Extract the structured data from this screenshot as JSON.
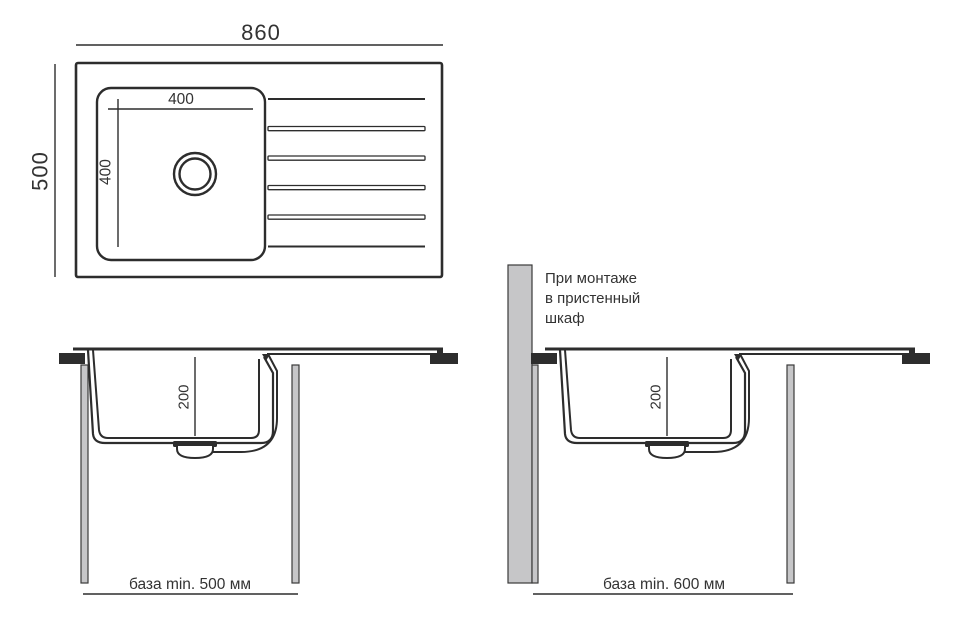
{
  "colors": {
    "line": "#2d2d2d",
    "text": "#333333",
    "panel_fill": "#c6c6c8",
    "panel_stroke": "#3a3a3a",
    "background": "#ffffff"
  },
  "top_view": {
    "overall_width_mm": "860",
    "overall_depth_mm": "500",
    "bowl_width_mm": "400",
    "bowl_length_mm": "400"
  },
  "section_standard": {
    "bowl_depth_mm": "200",
    "base_label": "база min. 500 мм"
  },
  "section_wall_cabinet": {
    "bowl_depth_mm": "200",
    "base_label": "база min. 600 мм",
    "note_line1": "При монтаже",
    "note_line2": "в пристенный",
    "note_line3": "шкаф"
  }
}
